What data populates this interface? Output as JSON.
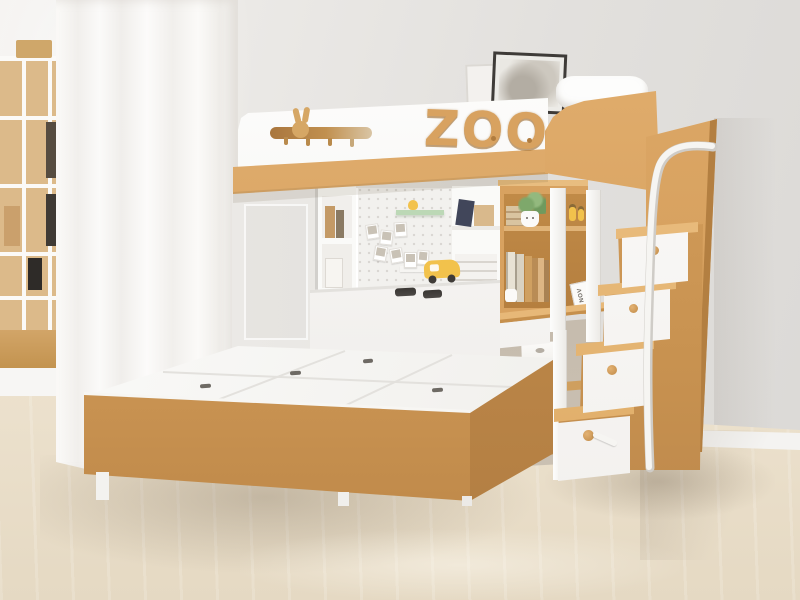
{
  "scene": {
    "type": "photograph",
    "setting": "children's bedroom",
    "furniture": "white and natural-wood loft bunk bed combo: upper bunk with ZOO sign and bunny hook rail, lower platform storage bed, under-loft shelving with pegboard, built-in desk with wooden hutch, storage staircase with drawer steps and white metal handrail",
    "decor": [
      "sheer white curtain",
      "white grid bookshelf with books",
      "two picture frames leaning on wall",
      "pegboard with pinned photos",
      "green acrylic shelf",
      "potted plant with face pot",
      "yellow toy scooter",
      "yellow figurines",
      "storage boxes and shopping bag under desk"
    ],
    "flooring": "light wood laminate",
    "lighting": "soft daylight from the left"
  },
  "bed_sign": {
    "text": "ZOO"
  },
  "calendar_card": {
    "text": "NOV"
  },
  "colors": {
    "wood": "#d8a260",
    "woodLight": "#eec289",
    "woodDark": "#b9854a",
    "white": "#fcfbfa",
    "wallLeft": "#f2f0ed",
    "wallRight": "#dbd9d6",
    "floor": "#eee4d2",
    "floorShadow": "#d9cdb9",
    "pegboard": "#f2f1ee",
    "green": "#bcd8b6",
    "yellow": "#f2c24c",
    "slotDark": "#4c4845",
    "frameDark": "#3e3b38",
    "curtain": "#fbfaf8"
  }
}
